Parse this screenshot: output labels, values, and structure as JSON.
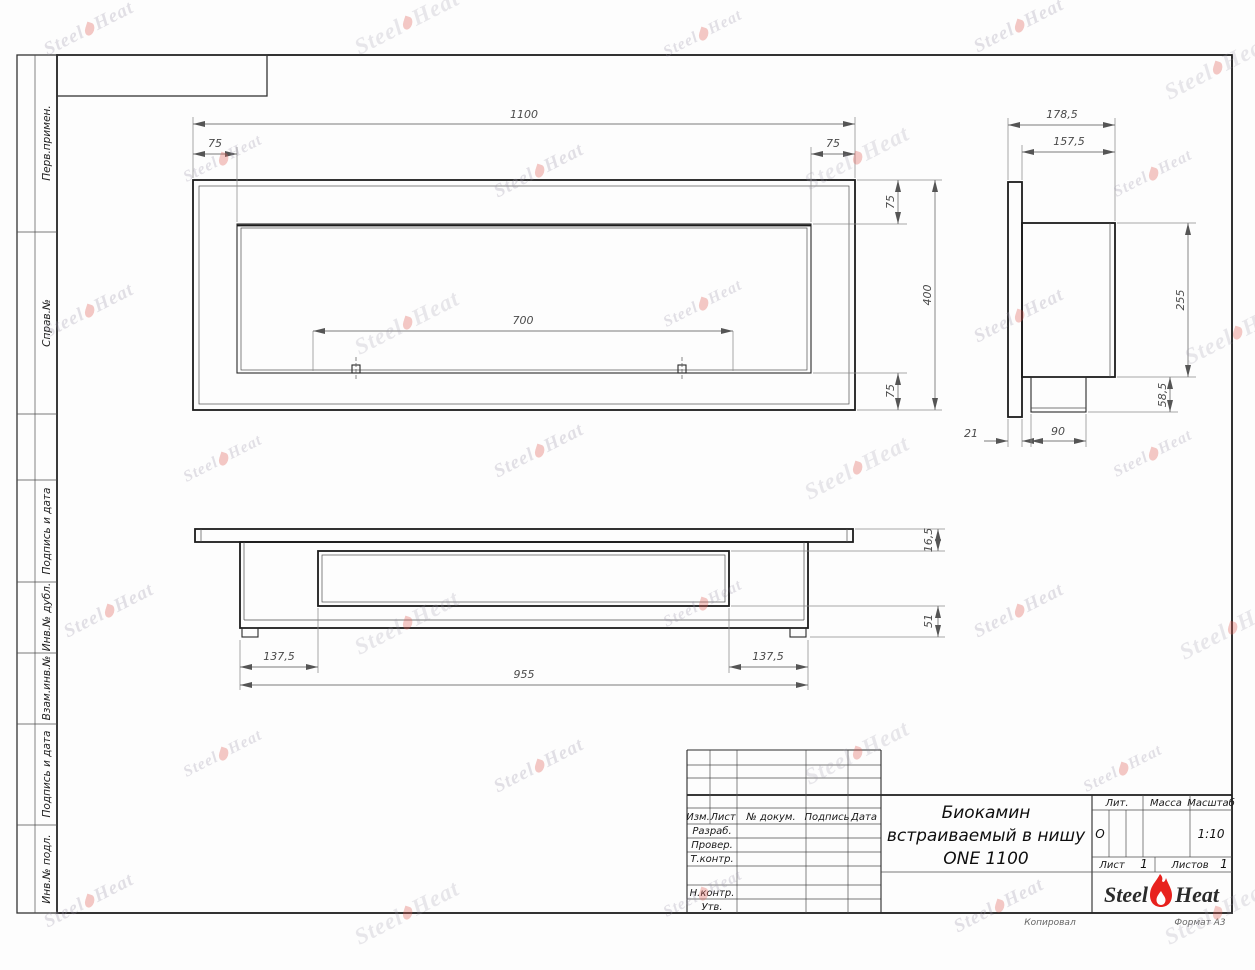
{
  "margin": {
    "cells": [
      {
        "label": "Перв.примен."
      },
      {
        "label": "Справ.№"
      },
      {
        "label": ""
      },
      {
        "label": "Подпись и дата"
      },
      {
        "label": "Инв.№ дубл."
      },
      {
        "label": "Взам.инв.№"
      },
      {
        "label": "Подпись и дата"
      },
      {
        "label": "Инв.№ подл."
      }
    ]
  },
  "dims": {
    "front": {
      "overall_width": "1100",
      "inset_left": "75",
      "inset_right": "75",
      "opening_width": "700",
      "inset_top": "75",
      "overall_height": "400",
      "inset_bottom": "75"
    },
    "side": {
      "overall_depth": "178,5",
      "body_depth": "157,5",
      "body_height": "255",
      "box_height": "58,5",
      "flange_thickness": "21",
      "box_width": "90"
    },
    "bottom": {
      "top_offset": "16,5",
      "lower_offset": "51",
      "left_offset": "137,5",
      "body_width": "955",
      "right_offset": "137,5"
    }
  },
  "title_block": {
    "rev_header": {
      "izm": "Изм.",
      "list": "Лист",
      "doc": "№ докум.",
      "sign": "Подпись",
      "date": "Дата"
    },
    "rows": {
      "razrab": "Разраб.",
      "prover": "Провер.",
      "tkontr": "Т.контр.",
      "nkontr": "Н.контр.",
      "utv": "Утв."
    },
    "title_line1": "Биокамин",
    "title_line2": "встраиваемый в нишу",
    "title_line3": "ONE 1100",
    "lit_label": "Лит.",
    "lit_value": "О",
    "massa_label": "Масса",
    "masshtab_label": "Масштаб",
    "scale_value": "1:10",
    "list_label": "Лист",
    "list_value": "1",
    "listov_label": "Листов",
    "listov_value": "1",
    "logo": {
      "steel": "Steel",
      "heat": "Heat",
      "flame_color": "#e8211d"
    },
    "kopiroval": "Копировал",
    "format": "Формат А3"
  },
  "watermark": {
    "steel": "Steel",
    "heat": "Heat"
  }
}
